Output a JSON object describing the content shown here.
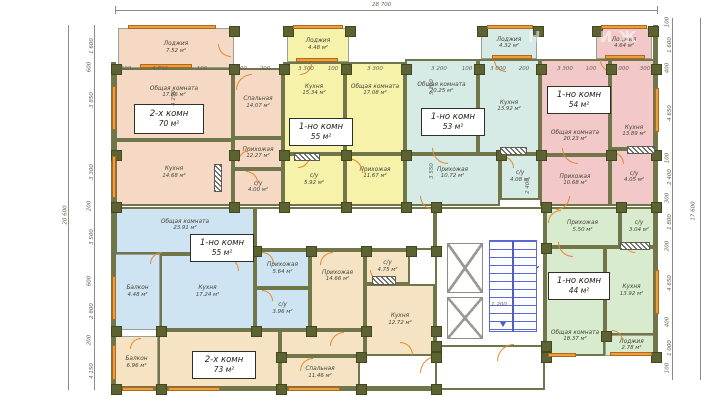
{
  "drawing": {
    "total_width_label": "28 700",
    "total_height_left_label": "20 600",
    "total_height_right_label": "17 600",
    "watermark": "НЕДВИЖ"
  },
  "apartments": [
    {
      "type_label": "2-х комн",
      "area_label": "70 м²",
      "color": "#f5d9c5",
      "box": {
        "x": 134,
        "y": 104,
        "w": 70,
        "h": 30
      }
    },
    {
      "type_label": "1-но комн",
      "area_label": "55 м²",
      "color": "#f7f2a9",
      "box": {
        "x": 289,
        "y": 118,
        "w": 64,
        "h": 28
      }
    },
    {
      "type_label": "1-но комн",
      "area_label": "53 м²",
      "color": "#d6eae6",
      "box": {
        "x": 421,
        "y": 108,
        "w": 64,
        "h": 28
      }
    },
    {
      "type_label": "1-но комн",
      "area_label": "54 м²",
      "color": "#f2c8c8",
      "box": {
        "x": 547,
        "y": 86,
        "w": 64,
        "h": 28
      }
    },
    {
      "type_label": "1-но комн",
      "area_label": "55 м²",
      "color": "#cfe4f2",
      "box": {
        "x": 190,
        "y": 234,
        "w": 64,
        "h": 28
      }
    },
    {
      "type_label": "2-х комн",
      "area_label": "73 м²",
      "color": "#f5e3c3",
      "box": {
        "x": 192,
        "y": 351,
        "w": 64,
        "h": 28
      }
    },
    {
      "type_label": "1-но комн",
      "area_label": "44 м²",
      "color": "#d8ebce",
      "box": {
        "x": 548,
        "y": 272,
        "w": 62,
        "h": 28
      }
    }
  ],
  "rooms": [
    {
      "apt": 0,
      "key": "loggia",
      "name": "Лоджия",
      "area": "7.52 м²",
      "x": 118,
      "y": 28,
      "w": 116,
      "h": 40,
      "thin": true
    },
    {
      "apt": 0,
      "key": "living",
      "name": "Общая комната",
      "area": "17.66 м²",
      "x": 115,
      "y": 68,
      "w": 118,
      "h": 72,
      "va": "t"
    },
    {
      "apt": 0,
      "key": "kitchen",
      "name": "Кухня",
      "area": "14.68 м²",
      "x": 115,
      "y": 140,
      "w": 118,
      "h": 66
    },
    {
      "apt": 0,
      "key": "bedroom",
      "name": "Спальная",
      "area": "14.07 м²",
      "x": 233,
      "y": 68,
      "w": 50,
      "h": 70
    },
    {
      "apt": 0,
      "key": "hall",
      "name": "Прихожая",
      "area": "12.27 м²",
      "x": 233,
      "y": 138,
      "w": 50,
      "h": 31
    },
    {
      "apt": 0,
      "key": "wc",
      "name": "с/у",
      "area": "4.00 м²",
      "x": 233,
      "y": 169,
      "w": 50,
      "h": 37
    },
    {
      "apt": 1,
      "key": "loggia",
      "name": "Лоджия",
      "area": "4.48 м²",
      "x": 287,
      "y": 28,
      "w": 62,
      "h": 34,
      "thin": true
    },
    {
      "apt": 1,
      "key": "kitchen",
      "name": "Кухня",
      "area": "15.34 м²",
      "x": 283,
      "y": 62,
      "w": 62,
      "h": 92,
      "va": "t"
    },
    {
      "apt": 1,
      "key": "living",
      "name": "Общая комната",
      "area": "17.08 м²",
      "x": 345,
      "y": 62,
      "w": 60,
      "h": 92,
      "va": "t"
    },
    {
      "apt": 1,
      "key": "wc",
      "name": "с/у",
      "area": "5.92 м²",
      "x": 283,
      "y": 154,
      "w": 62,
      "h": 52
    },
    {
      "apt": 1,
      "key": "hall",
      "name": "Прихожая",
      "area": "11.67 м²",
      "x": 345,
      "y": 154,
      "w": 60,
      "h": 52,
      "va": "t"
    },
    {
      "apt": 2,
      "key": "loggia",
      "name": "Лоджия",
      "area": "4.32 м²",
      "x": 481,
      "y": 28,
      "w": 56,
      "h": 31,
      "thin": true
    },
    {
      "apt": 2,
      "key": "living",
      "name": "Общая комната",
      "area": "20.25 м²",
      "x": 405,
      "y": 59,
      "w": 73,
      "h": 95,
      "va": "t"
    },
    {
      "apt": 2,
      "key": "kitchen",
      "name": "Кухня",
      "area": "13.92 м²",
      "x": 478,
      "y": 59,
      "w": 62,
      "h": 95
    },
    {
      "apt": 2,
      "key": "hall",
      "name": "Прихожая",
      "area": "10.72 м²",
      "x": 405,
      "y": 154,
      "w": 95,
      "h": 52,
      "va": "t"
    },
    {
      "apt": 2,
      "key": "wc",
      "name": "с/у",
      "area": "4.08 м²",
      "x": 500,
      "y": 154,
      "w": 40,
      "h": 46
    },
    {
      "apt": 3,
      "key": "loggia",
      "name": "Лоджия",
      "area": "4.64 м²",
      "x": 596,
      "y": 28,
      "w": 56,
      "h": 31,
      "thin": true
    },
    {
      "apt": 3,
      "key": "living",
      "name": "Общая комната",
      "area": "20.23 м²",
      "x": 540,
      "y": 59,
      "w": 70,
      "h": 96,
      "va": "b"
    },
    {
      "apt": 3,
      "key": "kitchen",
      "name": "Кухня",
      "area": "13.89 м²",
      "x": 610,
      "y": 59,
      "w": 48,
      "h": 90,
      "va": "b"
    },
    {
      "apt": 3,
      "key": "hall",
      "name": "Прихожая",
      "area": "10.68 м²",
      "x": 540,
      "y": 155,
      "w": 70,
      "h": 51
    },
    {
      "apt": 3,
      "key": "wc",
      "name": "с/у",
      "area": "4.05 м²",
      "x": 610,
      "y": 149,
      "w": 48,
      "h": 57
    },
    {
      "apt": 4,
      "key": "living",
      "name": "Общая комната",
      "area": "23.91 м²",
      "x": 115,
      "y": 207,
      "w": 140,
      "h": 47,
      "va": "t"
    },
    {
      "apt": 4,
      "key": "balcony",
      "name": "Балкон",
      "area": "4.48 м²",
      "x": 115,
      "y": 254,
      "w": 45,
      "h": 76,
      "thin": true
    },
    {
      "apt": 4,
      "key": "kitchen",
      "name": "Кухня",
      "area": "17.24 м²",
      "x": 160,
      "y": 254,
      "w": 95,
      "h": 76
    },
    {
      "apt": 4,
      "key": "hall",
      "name": "Прихожая",
      "area": "5.64 м²",
      "x": 255,
      "y": 250,
      "w": 55,
      "h": 38
    },
    {
      "apt": 4,
      "key": "wc",
      "name": "с/у",
      "area": "3.96 м²",
      "x": 255,
      "y": 288,
      "w": 55,
      "h": 42
    },
    {
      "apt": 5,
      "key": "balcony",
      "name": "Балкон",
      "area": "6.96 м²",
      "x": 115,
      "y": 336,
      "w": 43,
      "h": 54,
      "thin": true
    },
    {
      "apt": 5,
      "key": "living",
      "name": "Общая комната",
      "area": "23.09 м²",
      "x": 158,
      "y": 330,
      "w": 122,
      "h": 60,
      "va": "b"
    },
    {
      "apt": 5,
      "key": "bedroom",
      "name": "Спальная",
      "area": "11.46 м²",
      "x": 280,
      "y": 356,
      "w": 80,
      "h": 34
    },
    {
      "apt": 5,
      "key": "hall",
      "name": "Прихожая",
      "area": "14.66 м²",
      "x": 310,
      "y": 250,
      "w": 55,
      "h": 80,
      "va": "t"
    },
    {
      "apt": 5,
      "key": "filler",
      "x": 280,
      "y": 330,
      "w": 85,
      "h": 26
    },
    {
      "apt": 5,
      "key": "wc",
      "name": "с/у",
      "area": "4.75 м²",
      "x": 365,
      "y": 250,
      "w": 45,
      "h": 34
    },
    {
      "apt": 5,
      "key": "kitchen",
      "name": "Кухня",
      "area": "12.72 м²",
      "x": 365,
      "y": 284,
      "w": 70,
      "h": 72
    },
    {
      "apt": 6,
      "key": "hall",
      "name": "Прихожая",
      "area": "5.50 м²",
      "x": 545,
      "y": 207,
      "w": 75,
      "h": 40
    },
    {
      "apt": 6,
      "key": "wc",
      "name": "с/у",
      "area": "3.04 м²",
      "x": 620,
      "y": 207,
      "w": 38,
      "h": 40
    },
    {
      "apt": 6,
      "key": "living",
      "name": "Общая комната",
      "area": "18.37 м²",
      "x": 545,
      "y": 247,
      "w": 60,
      "h": 109,
      "va": "b"
    },
    {
      "apt": 6,
      "key": "kitchen",
      "name": "Кухня",
      "area": "13.92 м²",
      "x": 605,
      "y": 247,
      "w": 53,
      "h": 88
    },
    {
      "apt": 6,
      "key": "loggia",
      "name": "Лоджия",
      "area": "2.78 м²",
      "x": 605,
      "y": 335,
      "w": 53,
      "h": 21,
      "thin": true
    }
  ],
  "dim_top": [
    {
      "t": "600",
      "x": 126
    },
    {
      "t": "4 700",
      "x": 160
    },
    {
      "t": "100",
      "x": 202
    },
    {
      "t": "3 300",
      "x": 239
    },
    {
      "t": "200",
      "x": 265
    },
    {
      "t": "3 300",
      "x": 306
    },
    {
      "t": "100",
      "x": 333
    },
    {
      "t": "3 300",
      "x": 375
    },
    {
      "t": "200",
      "x": 406
    },
    {
      "t": "3 200",
      "x": 439
    },
    {
      "t": "100",
      "x": 467
    },
    {
      "t": "3 000",
      "x": 498
    },
    {
      "t": "200",
      "x": 524
    },
    {
      "t": "3 300",
      "x": 565
    },
    {
      "t": "100",
      "x": 591
    },
    {
      "t": "3 000",
      "x": 621
    },
    {
      "t": "300",
      "x": 645
    }
  ],
  "dim_left": [
    {
      "t": "1 600",
      "y": 46
    },
    {
      "t": "600",
      "y": 67
    },
    {
      "t": "3 850",
      "y": 100
    },
    {
      "t": "3 300",
      "y": 172
    },
    {
      "t": "200",
      "y": 206
    },
    {
      "t": "3 500",
      "y": 237
    },
    {
      "t": "600",
      "y": 281
    },
    {
      "t": "2 800",
      "y": 311
    },
    {
      "t": "200",
      "y": 340
    },
    {
      "t": "4 150",
      "y": 371
    }
  ],
  "dim_right": [
    {
      "t": "100",
      "y": 22
    },
    {
      "t": "1 600",
      "y": 45
    },
    {
      "t": "400",
      "y": 68
    },
    {
      "t": "4 650",
      "y": 113
    },
    {
      "t": "100",
      "y": 158
    },
    {
      "t": "2 400",
      "y": 177
    },
    {
      "t": "300",
      "y": 198
    },
    {
      "t": "1 800",
      "y": 222
    },
    {
      "t": "200",
      "y": 246
    },
    {
      "t": "4 650",
      "y": 283
    },
    {
      "t": "400",
      "y": 322
    },
    {
      "t": "1 000",
      "y": 348
    },
    {
      "t": "100",
      "y": 368
    }
  ],
  "dim_inner": [
    {
      "t": "5 300",
      "x": 432,
      "y": 87,
      "rot": true
    },
    {
      "t": "3 550",
      "x": 432,
      "y": 171,
      "rot": true
    },
    {
      "t": "2 400",
      "x": 528,
      "y": 186,
      "rot": true
    },
    {
      "t": "4 250",
      "x": 174,
      "y": 98,
      "rot": true
    },
    {
      "t": "1 200",
      "x": 499,
      "y": 305
    }
  ],
  "columns": [
    [
      233,
      30
    ],
    [
      287,
      30
    ],
    [
      349,
      30
    ],
    [
      481,
      30
    ],
    [
      537,
      30
    ],
    [
      596,
      30
    ],
    [
      652,
      30
    ],
    [
      115,
      68
    ],
    [
      233,
      68
    ],
    [
      283,
      68
    ],
    [
      345,
      68
    ],
    [
      405,
      68
    ],
    [
      478,
      68
    ],
    [
      540,
      68
    ],
    [
      610,
      68
    ],
    [
      655,
      68
    ],
    [
      115,
      154
    ],
    [
      233,
      154
    ],
    [
      283,
      154
    ],
    [
      345,
      154
    ],
    [
      405,
      154
    ],
    [
      500,
      154
    ],
    [
      540,
      154
    ],
    [
      610,
      154
    ],
    [
      655,
      154
    ],
    [
      115,
      206
    ],
    [
      233,
      206
    ],
    [
      283,
      206
    ],
    [
      345,
      206
    ],
    [
      405,
      206
    ],
    [
      435,
      206
    ],
    [
      545,
      206
    ],
    [
      620,
      206
    ],
    [
      655,
      206
    ],
    [
      255,
      250
    ],
    [
      310,
      250
    ],
    [
      365,
      250
    ],
    [
      410,
      250
    ],
    [
      435,
      250
    ],
    [
      545,
      247
    ],
    [
      115,
      330
    ],
    [
      160,
      330
    ],
    [
      255,
      330
    ],
    [
      310,
      330
    ],
    [
      365,
      330
    ],
    [
      435,
      330
    ],
    [
      280,
      356
    ],
    [
      360,
      356
    ],
    [
      435,
      356
    ],
    [
      545,
      356
    ],
    [
      605,
      335
    ],
    [
      655,
      356
    ],
    [
      115,
      388
    ],
    [
      160,
      388
    ],
    [
      280,
      388
    ],
    [
      360,
      388
    ],
    [
      435,
      388
    ],
    [
      435,
      345
    ],
    [
      545,
      345
    ]
  ],
  "windows": [
    [
      128,
      25,
      88,
      4
    ],
    [
      293,
      25,
      50,
      4
    ],
    [
      487,
      25,
      46,
      4
    ],
    [
      601,
      25,
      46,
      4
    ],
    [
      140,
      64,
      52,
      4
    ],
    [
      296,
      58,
      42,
      4
    ],
    [
      492,
      55,
      40,
      4
    ],
    [
      605,
      55,
      40,
      4
    ],
    [
      112,
      86,
      4,
      44
    ],
    [
      112,
      156,
      4,
      42
    ],
    [
      112,
      276,
      4,
      44
    ],
    [
      112,
      345,
      4,
      35
    ],
    [
      655,
      88,
      4,
      44
    ],
    [
      655,
      270,
      4,
      44
    ],
    [
      122,
      387,
      32,
      4
    ],
    [
      168,
      387,
      52,
      4
    ],
    [
      288,
      387,
      52,
      4
    ],
    [
      610,
      352,
      42,
      4
    ],
    [
      548,
      353,
      28,
      4
    ]
  ],
  "doors": [
    [
      218,
      44,
      13,
      "bl"
    ],
    [
      236,
      74,
      16,
      "tl"
    ],
    [
      238,
      150,
      12,
      "tl"
    ],
    [
      246,
      171,
      12,
      "tr"
    ],
    [
      300,
      63,
      12,
      "br"
    ],
    [
      322,
      122,
      16,
      "br"
    ],
    [
      298,
      156,
      12,
      "br"
    ],
    [
      348,
      158,
      15,
      "tr"
    ],
    [
      494,
      60,
      12,
      "bl"
    ],
    [
      432,
      148,
      16,
      "bl"
    ],
    [
      502,
      156,
      12,
      "tr"
    ],
    [
      420,
      196,
      14,
      "bl"
    ],
    [
      600,
      60,
      12,
      "bl"
    ],
    [
      562,
      148,
      16,
      "bl"
    ],
    [
      612,
      152,
      12,
      "tr"
    ],
    [
      556,
      196,
      14,
      "br"
    ],
    [
      150,
      252,
      12,
      "tl"
    ],
    [
      224,
      256,
      15,
      "tr"
    ],
    [
      262,
      252,
      12,
      "tr"
    ],
    [
      262,
      290,
      11,
      "tr"
    ],
    [
      130,
      338,
      11,
      "tl"
    ],
    [
      330,
      332,
      14,
      "tl"
    ],
    [
      370,
      270,
      11,
      "bl"
    ],
    [
      300,
      358,
      13,
      "tl"
    ],
    [
      320,
      252,
      13,
      "tl"
    ],
    [
      400,
      342,
      13,
      "tr"
    ],
    [
      558,
      242,
      15,
      "bl"
    ],
    [
      624,
      242,
      11,
      "bl"
    ],
    [
      612,
      330,
      11,
      "tr"
    ],
    [
      548,
      210,
      13,
      "tl"
    ],
    [
      420,
      356,
      17,
      "tl"
    ],
    [
      497,
      344,
      17,
      "tl"
    ]
  ],
  "hatches": [
    [
      294,
      153,
      26,
      8
    ],
    [
      214,
      164,
      8,
      28
    ],
    [
      500,
      147,
      27,
      8
    ],
    [
      627,
      146,
      28,
      8
    ],
    [
      620,
      242,
      30,
      8
    ],
    [
      372,
      276,
      24,
      9
    ]
  ]
}
